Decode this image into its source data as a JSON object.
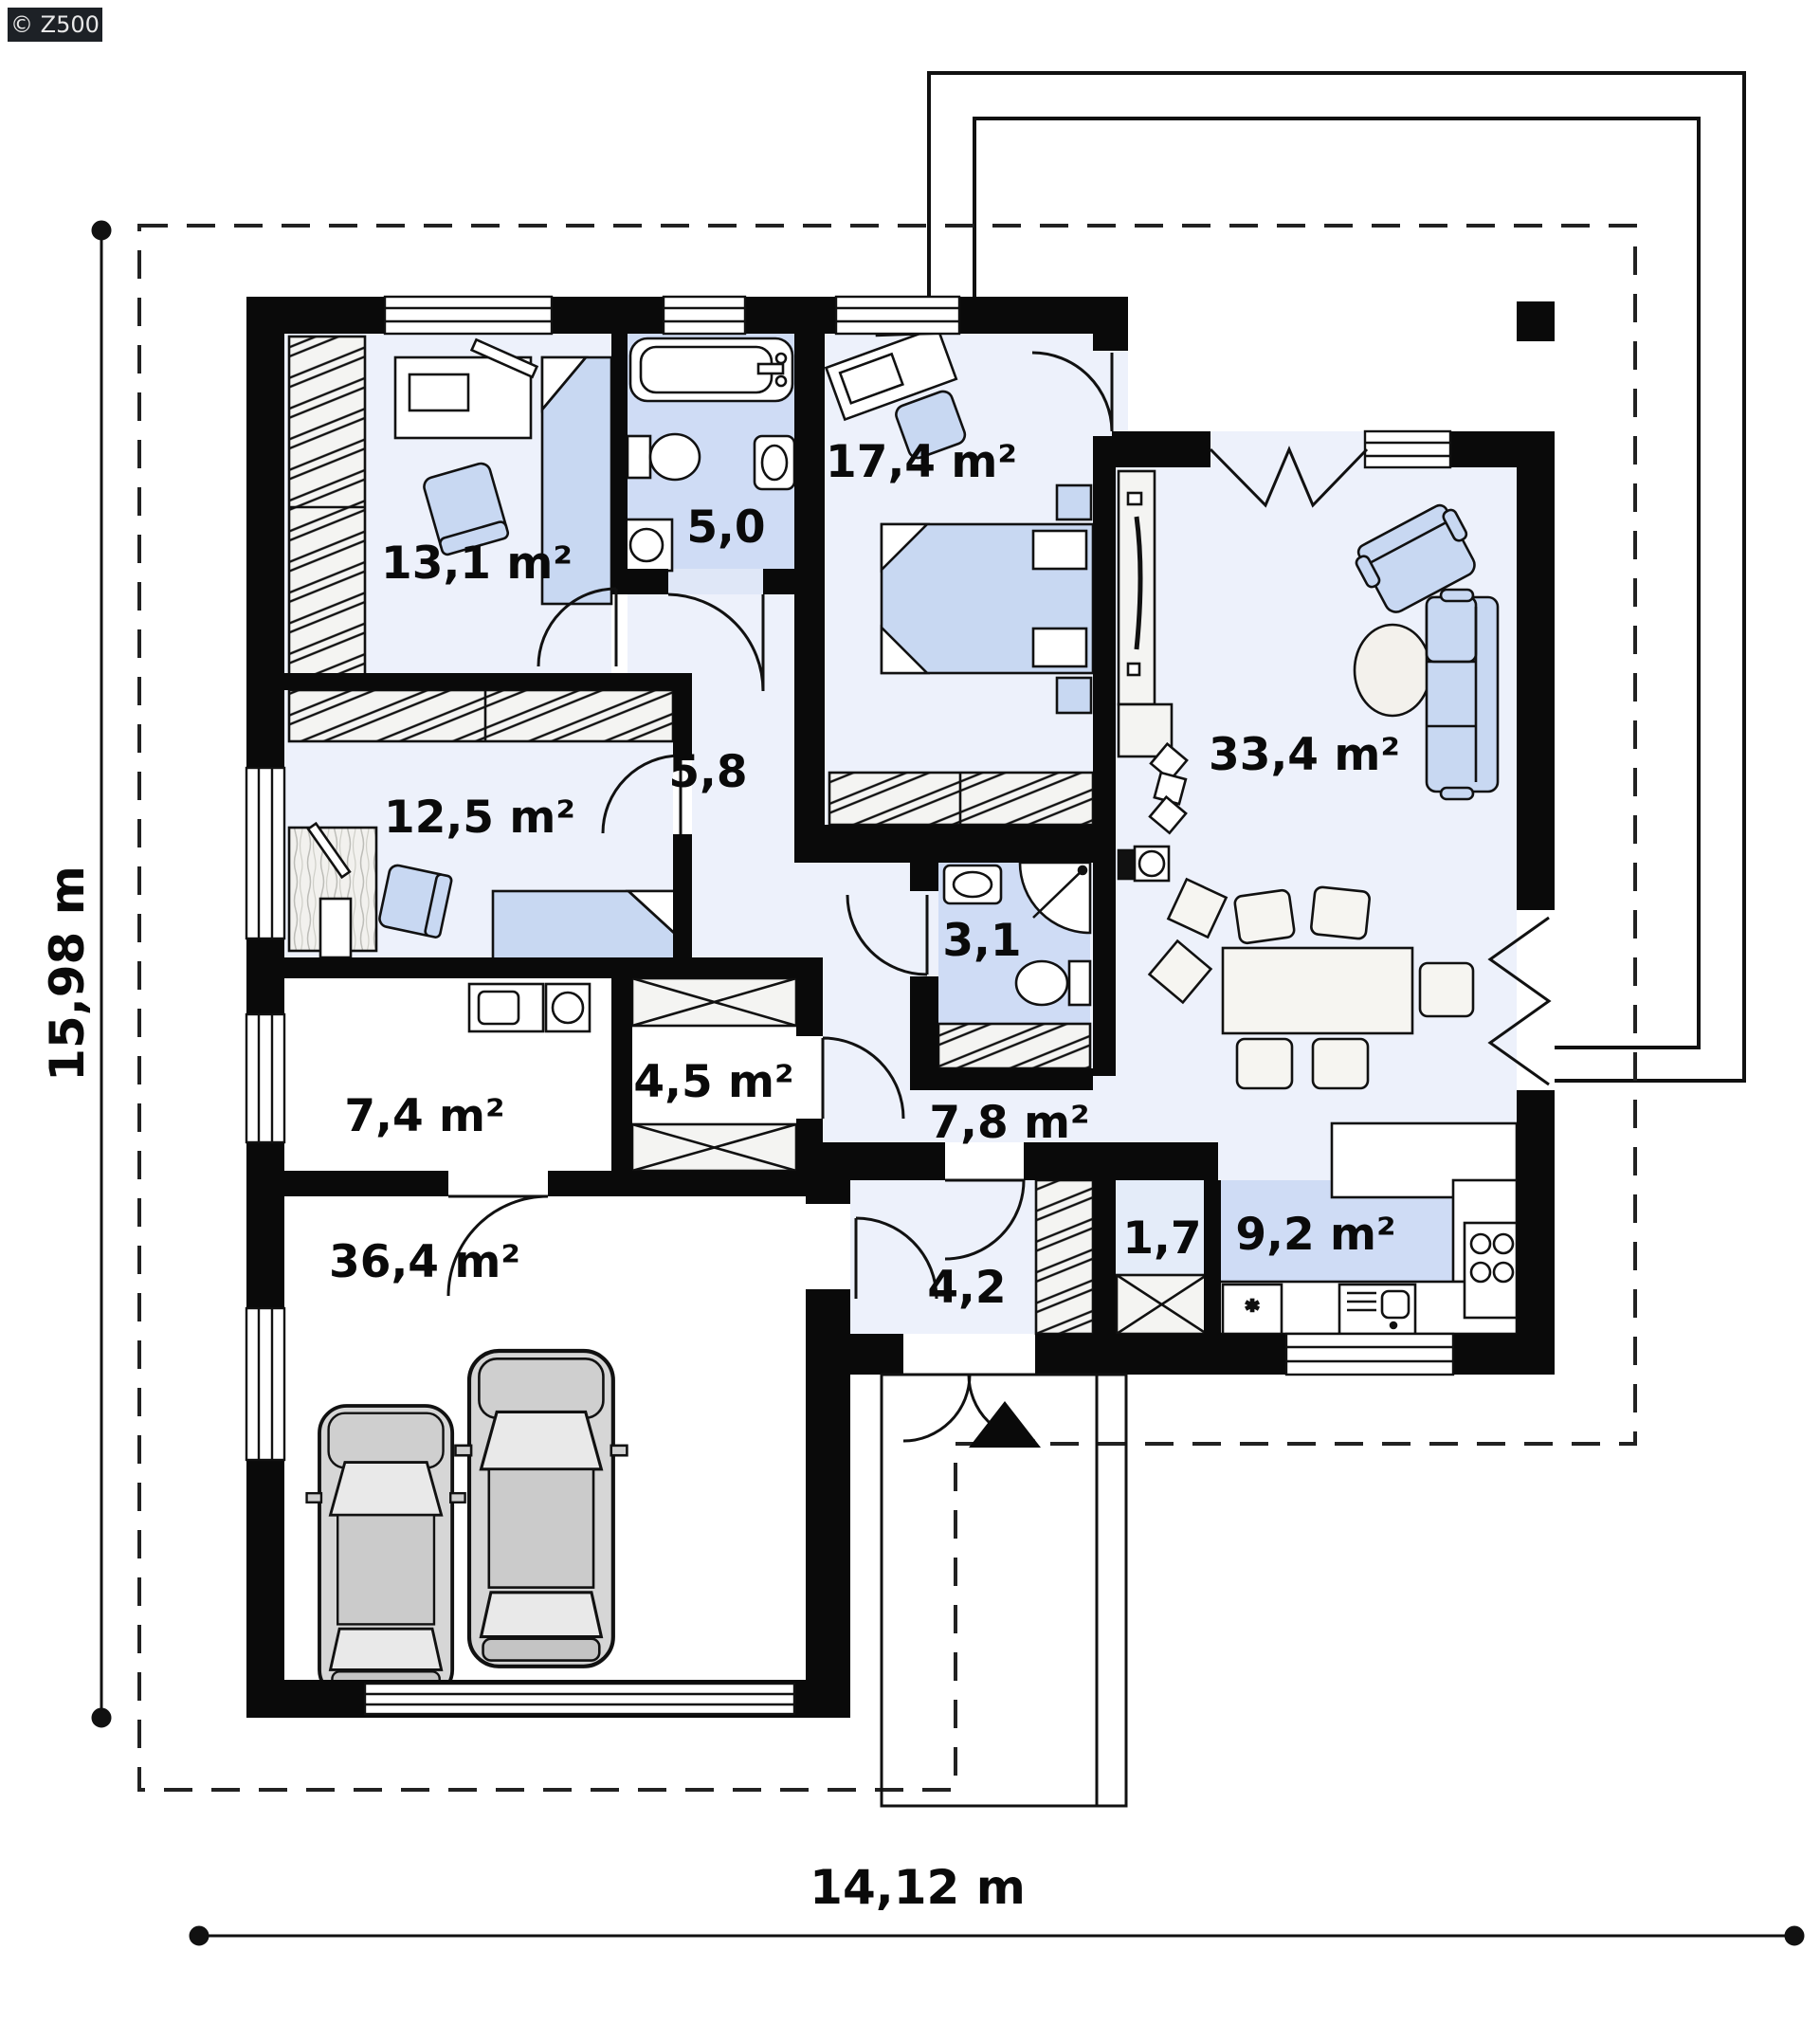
{
  "watermark": "© Z500",
  "dimensions": {
    "left": "15,98 m",
    "bottom": "14,12 m"
  },
  "rooms": {
    "bedroom1": "13,1 m²",
    "bath": "5,0",
    "bedroom2": "17,4 m²",
    "living": "33,4 m²",
    "hall": "5,8",
    "bedroom3": "12,5 m²",
    "wc": "3,1",
    "utility": "7,4 m²",
    "wardrobe": "4,5 m²",
    "corridor": "7,8 m²",
    "garage": "36,4 m²",
    "entry": "4,2",
    "pantry": "1,7",
    "kitchen": "9,2 m²"
  },
  "colors": {
    "wall": "#0a0a0a",
    "floor_light": "#edf1fb",
    "floor_blue": "#cfdcf5",
    "furniture_blue": "#c8d8f2",
    "car_gray": "#d6d6d6"
  }
}
